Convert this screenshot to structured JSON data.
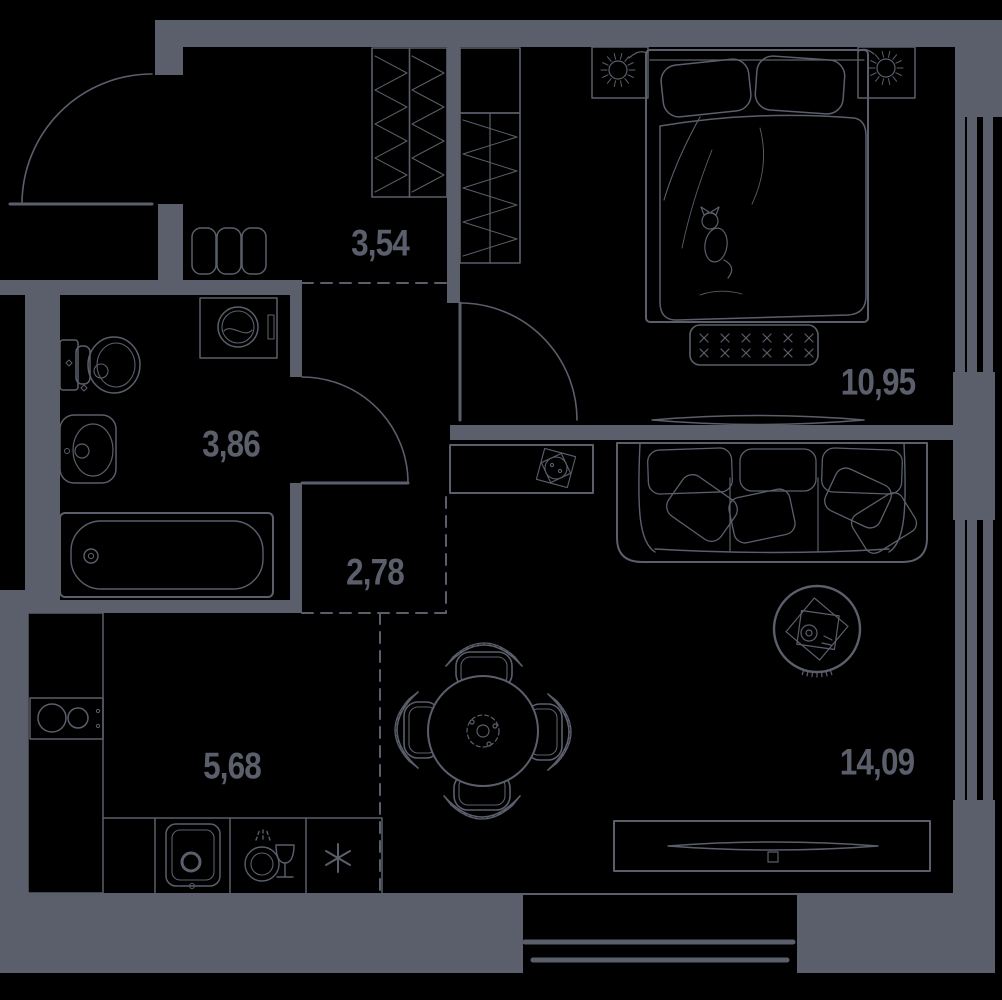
{
  "colors": {
    "background": "#000000",
    "line": "#5a5f6b",
    "label_text": "#5a5f6b"
  },
  "rooms": {
    "hallway_upper": {
      "area_label": "3,54"
    },
    "bathroom": {
      "area_label": "3,86"
    },
    "hallway_lower": {
      "area_label": "2,78"
    },
    "kitchen": {
      "area_label": "5,68"
    },
    "bedroom": {
      "area_label": "10,95"
    },
    "living_room": {
      "area_label": "14,09"
    }
  },
  "fixtures": [
    "entrance-door-icon",
    "bedroom-door-icon",
    "bathroom-door-icon",
    "wardrobe-icon",
    "shoe-cabinet-icon",
    "washing-machine-icon",
    "toilet-icon",
    "washbasin-icon",
    "bathtub-icon",
    "stove-icon",
    "kitchen-sink-icon",
    "dishwasher-icon",
    "fridge-icon",
    "dining-table-icon",
    "chair-icon",
    "rug-icon",
    "sofa-icon",
    "bed-icon",
    "bench-icon",
    "nightstand-icon",
    "lamp-icon",
    "tv-icon",
    "tv-console-icon",
    "dresser-icon",
    "plant-icon",
    "window-icon",
    "balcony-icon"
  ]
}
